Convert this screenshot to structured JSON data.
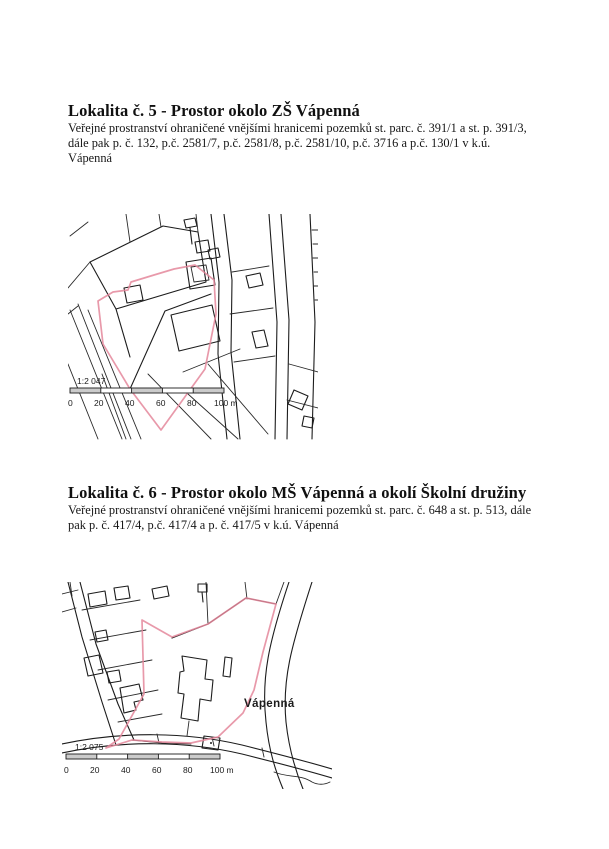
{
  "sections": [
    {
      "heading": "Lokalita č. 5 - Prostor okolo ZŠ Vápenná",
      "description_lines": [
        "Veřejné prostranství ohraničené vnějšími hranicemi pozemků st. parc. č. 391/1 a st. p. 391/3,",
        "dále pak p. č. 132, p.č. 2581/7, p.č. 2581/8, p.č. 2581/10, p.č. 3716 a p.č. 130/1 v k.ú.",
        "Vápenná"
      ],
      "map": {
        "scale_text": "1:2 047",
        "ticks": [
          "0",
          "20",
          "40",
          "60",
          "80",
          "100 m"
        ]
      }
    },
    {
      "heading": "Lokalita č. 6 - Prostor okolo MŠ Vápenná a okolí Školní družiny",
      "description_lines": [
        "Veřejné prostranství ohraničené vnějšími hranicemi pozemků st. parc. č. 648 a st. p. 513, dále",
        "pak p. č. 417/4, p.č. 417/4 a p. č. 417/5 v k.ú. Vápenná"
      ],
      "map": {
        "scale_text": "1:2 075",
        "ticks": [
          "0",
          "20",
          "40",
          "60",
          "80",
          "100 m"
        ],
        "place_label": "Vápenná"
      }
    }
  ],
  "colors": {
    "boundary": "#e4879b",
    "line": "#1c1c1c",
    "paper": "#ffffff"
  }
}
